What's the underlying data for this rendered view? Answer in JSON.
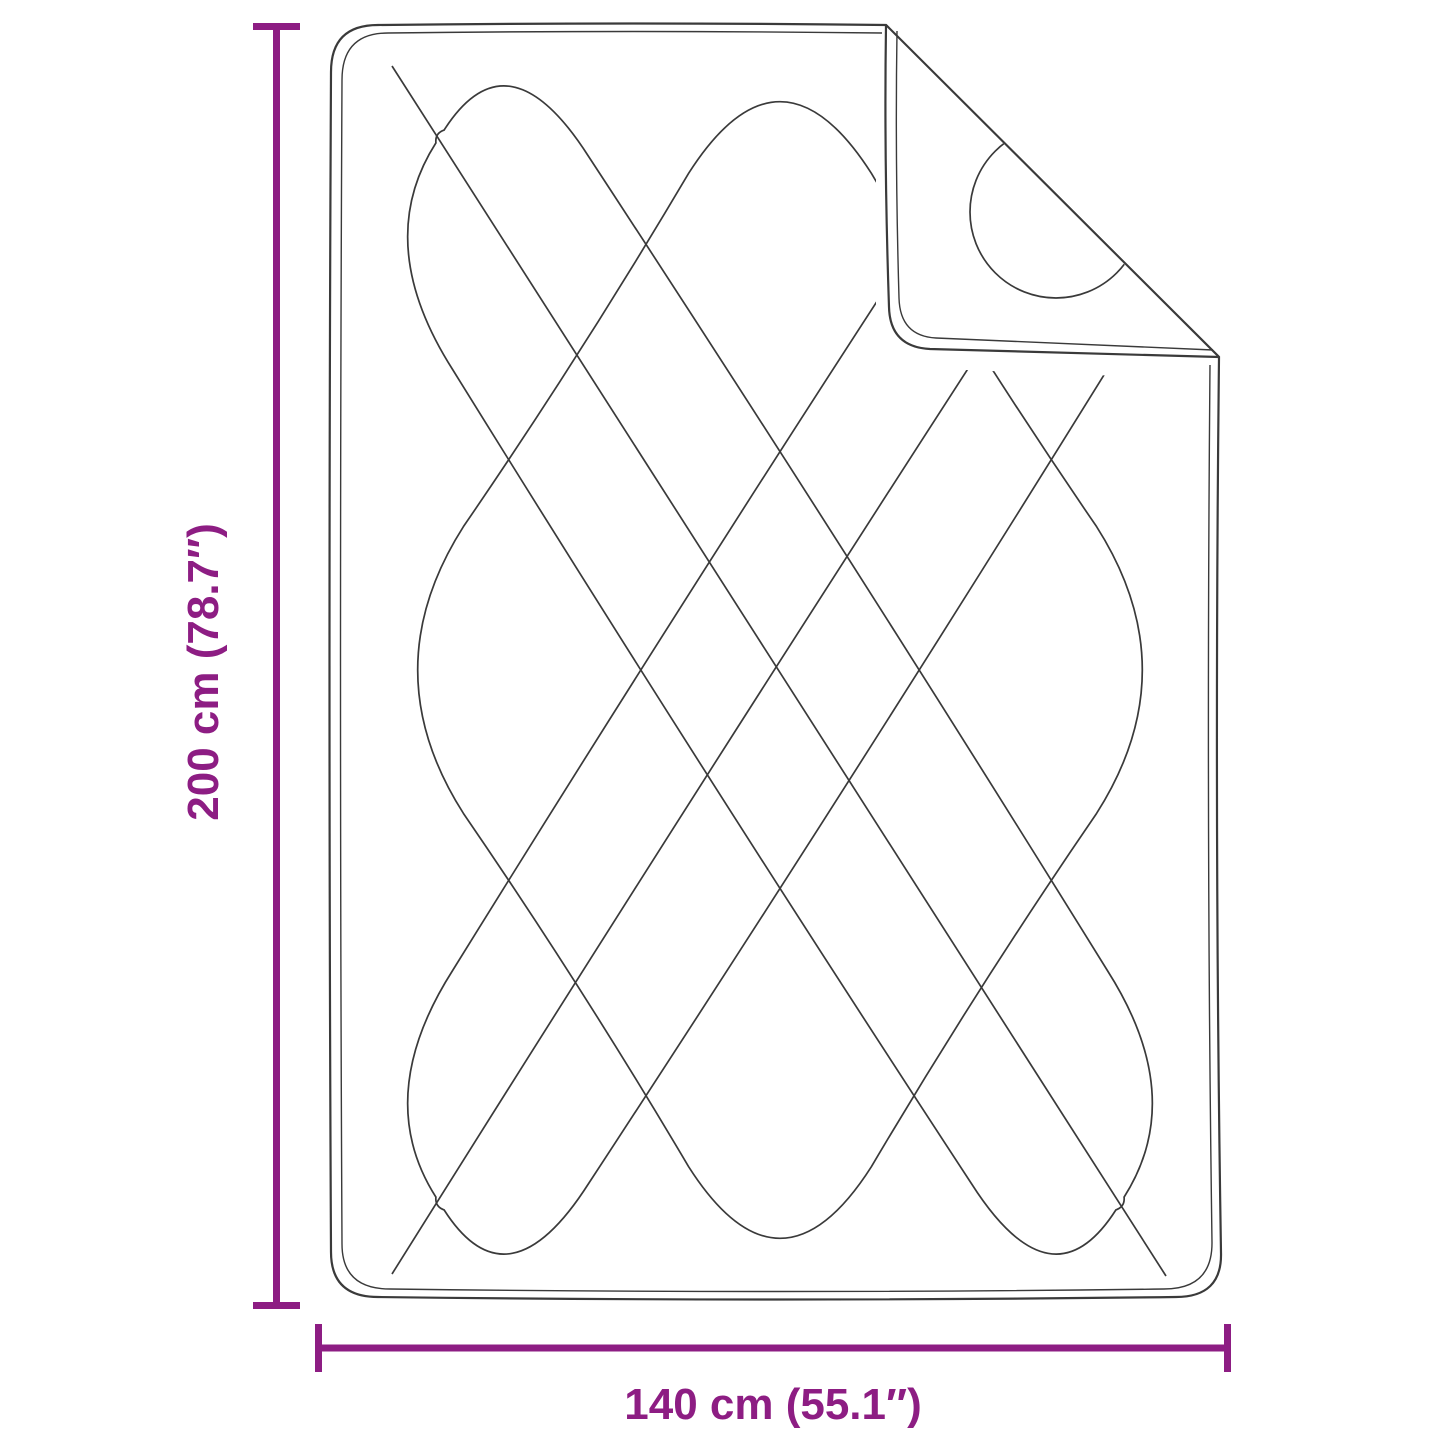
{
  "diagram": {
    "type": "product-dimension-drawing",
    "subject": "quilted-blanket-with-folded-corner",
    "height_dimension": {
      "label": "200 cm (78.7″)"
    },
    "width_dimension": {
      "label": "140 cm (55.1″)"
    }
  },
  "colors": {
    "accent": "#8d1d83",
    "line": "#3a3a3a",
    "background": "#ffffff"
  }
}
